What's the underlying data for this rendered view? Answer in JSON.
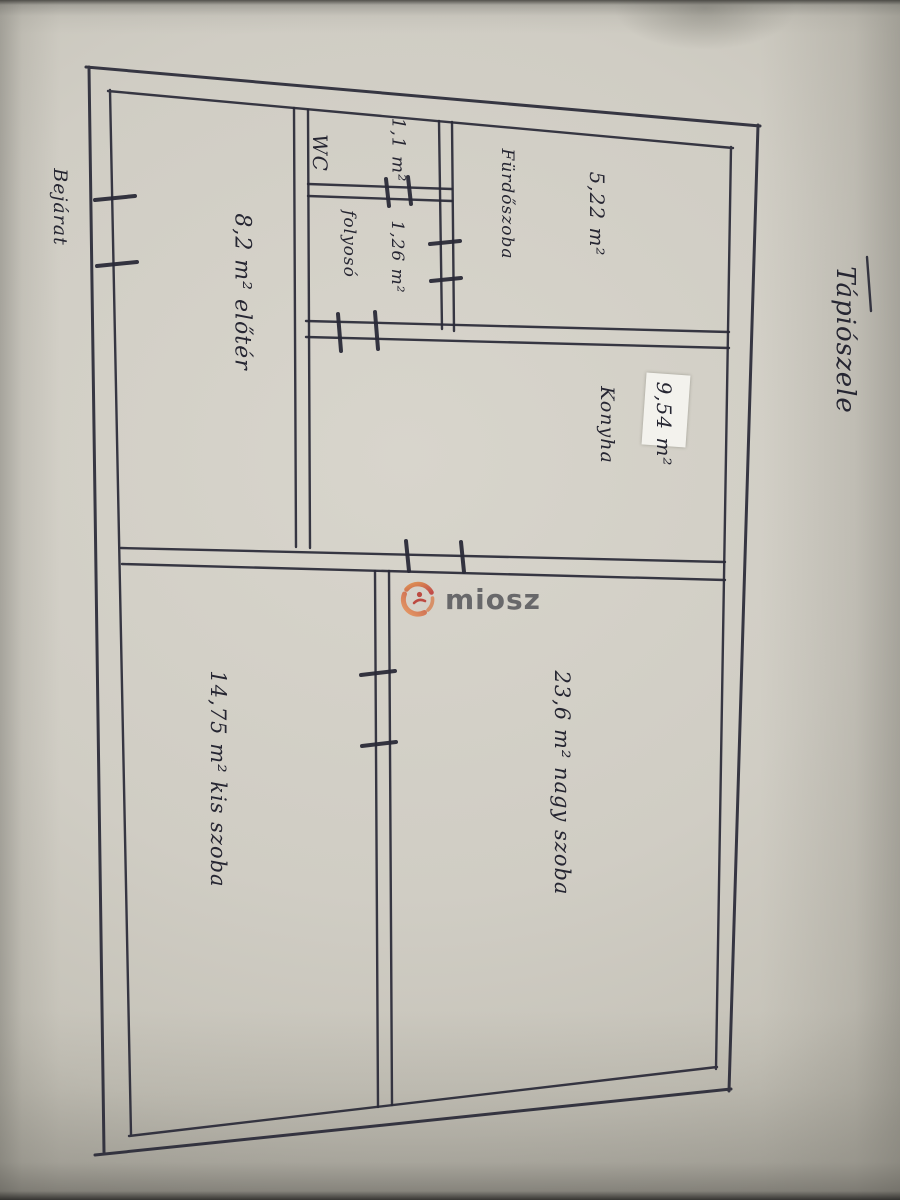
{
  "document": {
    "type": "hand-drawn floor plan photo",
    "title": "Tápiószele",
    "entrance_label": "Bejárat"
  },
  "labels": {
    "title": "Tápiószele",
    "entrance": "Bejárat",
    "eloter": "8,2 m² előtér",
    "wc": "WC",
    "wc_area": "1,1 m²",
    "hallway": "folyosó",
    "hallway_area": "1,26 m²",
    "bathroom": "Fürdőszoba",
    "bathroom_area": "5,22 m²",
    "kitchen": "Konyha",
    "kitchen_area": "9,54 m²",
    "big_room": "23,6 m² nagy szoba",
    "small_room": "14,75 m² kis szoba"
  },
  "rooms": [
    {
      "name": "előtér",
      "area": "8,2 m²"
    },
    {
      "name": "WC",
      "area": "1,1 m²"
    },
    {
      "name": "folyosó",
      "area": "1,26 m²"
    },
    {
      "name": "Fürdőszoba",
      "area": "5,22 m²"
    },
    {
      "name": "Konyha",
      "area": "9,54 m²"
    },
    {
      "name": "nagy szoba",
      "area": "23,6 m²"
    },
    {
      "name": "kis szoba",
      "area": "14,75 m²"
    }
  ],
  "watermark": {
    "brand": "miosz",
    "logo_icon": "circular-swirl-figures",
    "colors": {
      "red": "#bf3a38",
      "orange": "#e08a45",
      "text": "#5a5a5e"
    }
  },
  "colors": {
    "paper": "#d0cdc4",
    "ink": "#2a2a38",
    "sticker": "#f3f2ed"
  }
}
